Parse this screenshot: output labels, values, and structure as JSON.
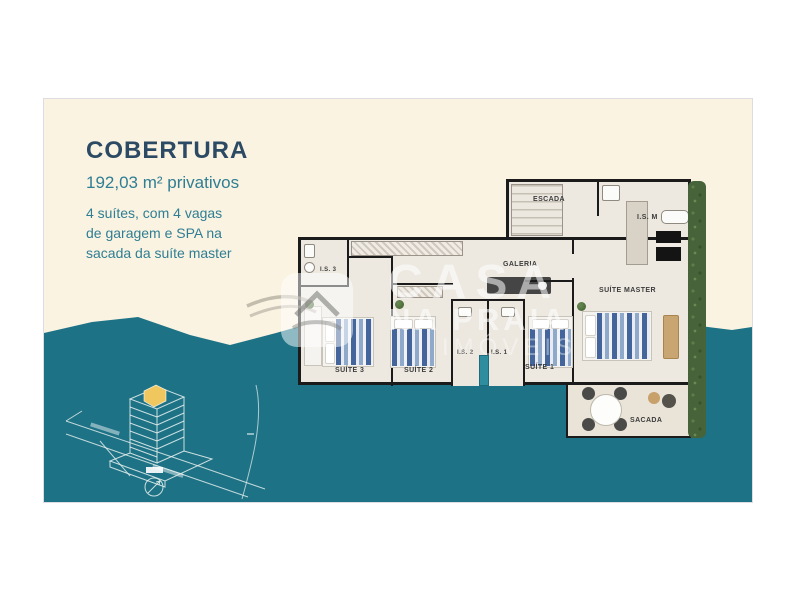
{
  "info_panel": {
    "title": "COBERTURA",
    "area": "192,03 m² privativos",
    "desc1": "4 suítes, com 4 vagas",
    "desc2": "de garagem e SPA na",
    "desc3": "sacada da suíte master"
  },
  "floorplan": {
    "rooms": {
      "escada": "ESCADA",
      "is_master": "I.S. M",
      "galeria": "GALERIA",
      "suite_master": "SUÍTE MASTER",
      "is3": "I.S. 3",
      "suite3": "SUÍTE 3",
      "suite2": "SUÍTE 2",
      "is2": "I.S. 2",
      "is1": "I.S. 1",
      "suite1": "SUÍTE 1",
      "sacada": "SACADA"
    }
  },
  "watermark": {
    "brand_top": "CASA",
    "brand_mid": "NA PRAIA",
    "brand_bottom": "IMÓVEIS"
  },
  "colors": {
    "cream": "#FAF3E2",
    "sea_teal": "#1E7286",
    "title_navy": "#2C4A63",
    "body_teal": "#2F7E93",
    "highlight_yellow": "#F0C75E",
    "wall_black": "#1b1b1b"
  }
}
